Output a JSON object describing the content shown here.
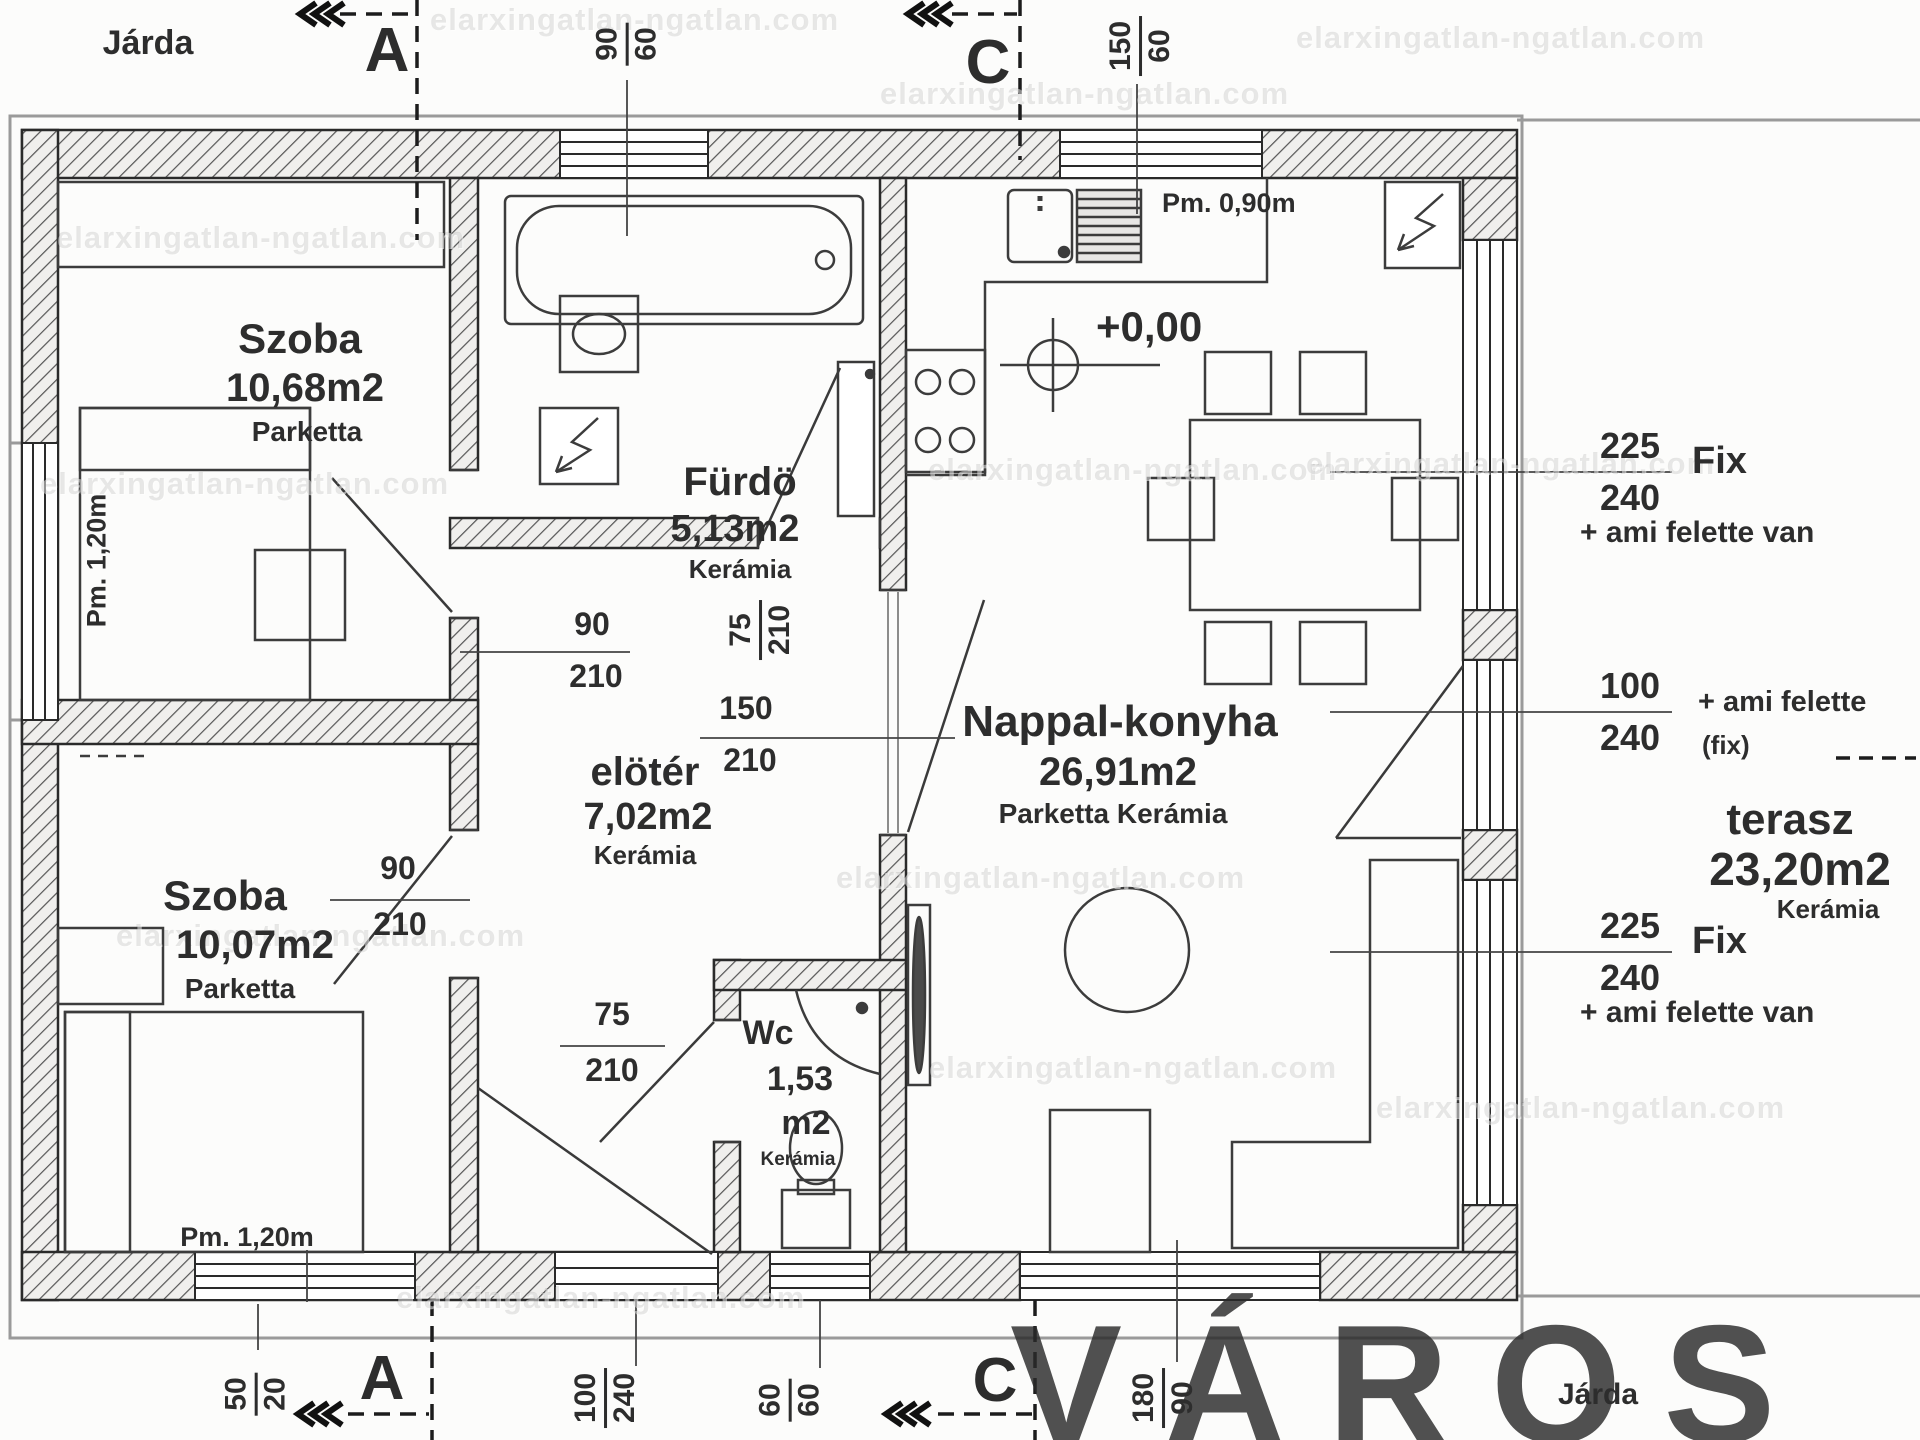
{
  "labels": {
    "jarda_top": "Járda",
    "jarda_bottom": "Járda"
  },
  "markers": {
    "a": "A",
    "c": "C"
  },
  "rooms": {
    "szoba1": {
      "name": "Szoba",
      "area": "10,68m2",
      "floor": "Parketta"
    },
    "szoba2": {
      "name": "Szoba",
      "area": "10,07m2",
      "floor": "Parketta"
    },
    "furdo": {
      "name": "Fürdö",
      "area": "5,13m2",
      "floor": "Kerámia"
    },
    "eloter": {
      "name": "elötér",
      "area": "7,02m2",
      "floor": "Kerámia"
    },
    "wc": {
      "name": "Wc",
      "area_line1": "1,53",
      "area_line2": "m2",
      "floor": "Kerámia"
    },
    "nappali": {
      "name": "Nappal-konyha",
      "area": "26,91m2",
      "floor": "Parketta Kerámia"
    },
    "terasz": {
      "name": "terasz",
      "area": "23,20m2",
      "floor": "Kerámia"
    }
  },
  "dims": {
    "bath_window": {
      "num": "90",
      "den": "60"
    },
    "kitchen_window": {
      "num": "150",
      "den": "60"
    },
    "szoba1_door": {
      "num": "90",
      "den": "210"
    },
    "furdo_door": {
      "num": "75",
      "den": "210"
    },
    "passage": {
      "num": "150",
      "den": "210"
    },
    "szoba2_door": {
      "num": "90",
      "den": "210"
    },
    "wc_door": {
      "num": "75",
      "den": "210"
    },
    "left_sill": {
      "num": "50",
      "den": "20"
    },
    "entrance_door": {
      "num": "100",
      "den": "240"
    },
    "wc_window": {
      "num": "60",
      "den": "60"
    },
    "terrace_window": {
      "num": "180",
      "den": "90"
    },
    "fix_upper": {
      "num": "225",
      "den": "240"
    },
    "terrace_door": {
      "num": "100",
      "den": "240"
    },
    "fix_lower": {
      "num": "225",
      "den": "240"
    }
  },
  "annotations": {
    "fix": "Fix",
    "ami_van": "+ ami felette van",
    "ami": "+ ami felette",
    "fix_paren": "(fix)",
    "pm_090": "Pm. 0,90m",
    "pm_120": "Pm. 1,20m",
    "elevation": "+0,00"
  },
  "watermark": {
    "big": "VÁROS",
    "small": "elarxingatlan-ngatlan.com"
  }
}
